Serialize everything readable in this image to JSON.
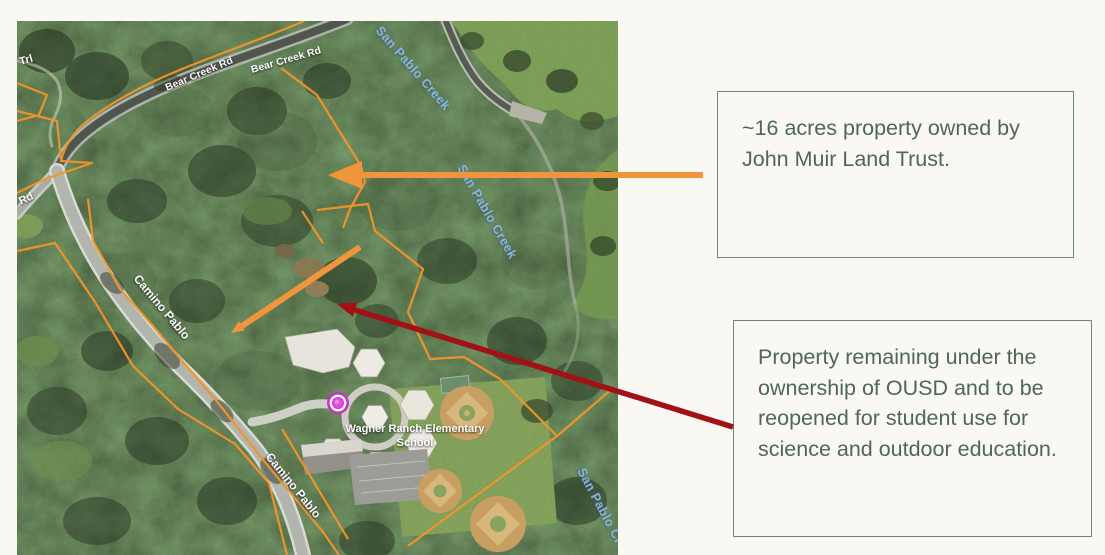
{
  "page": {
    "background": "#faf8f2"
  },
  "map": {
    "road_labels": {
      "trail": "or Trl",
      "bear_creek_a": "Bear Creek Rd",
      "bear_creek_b": "Bear Creek Rd",
      "left_road": "n Rd",
      "camino_a": "Camino Pablo",
      "camino_b": "Camino Pablo"
    },
    "creek_labels": {
      "top": "San Pablo Creek",
      "mid": "San Pablo Creek",
      "bottom": "San Pablo Cre"
    },
    "poi": {
      "school_line1": "Wagner Ranch Elementary",
      "school_line2": "School"
    },
    "colors": {
      "parcel_boundary": "#f59429",
      "creek_text": "#8ab7e6",
      "road_text": "#ffffff",
      "school_marker": "#cc2fcc"
    }
  },
  "callouts": {
    "jmlt": {
      "text": "~16 acres property owned by John Muir Land Trust."
    },
    "ousd": {
      "text": "Property remaining under the ownership of OUSD and to be reopened for student use for science and outdoor education."
    },
    "box_border_color": "#6d8877",
    "text_color": "#506758",
    "arrow_orange": "#f0953c",
    "arrow_red": "#a11115"
  }
}
